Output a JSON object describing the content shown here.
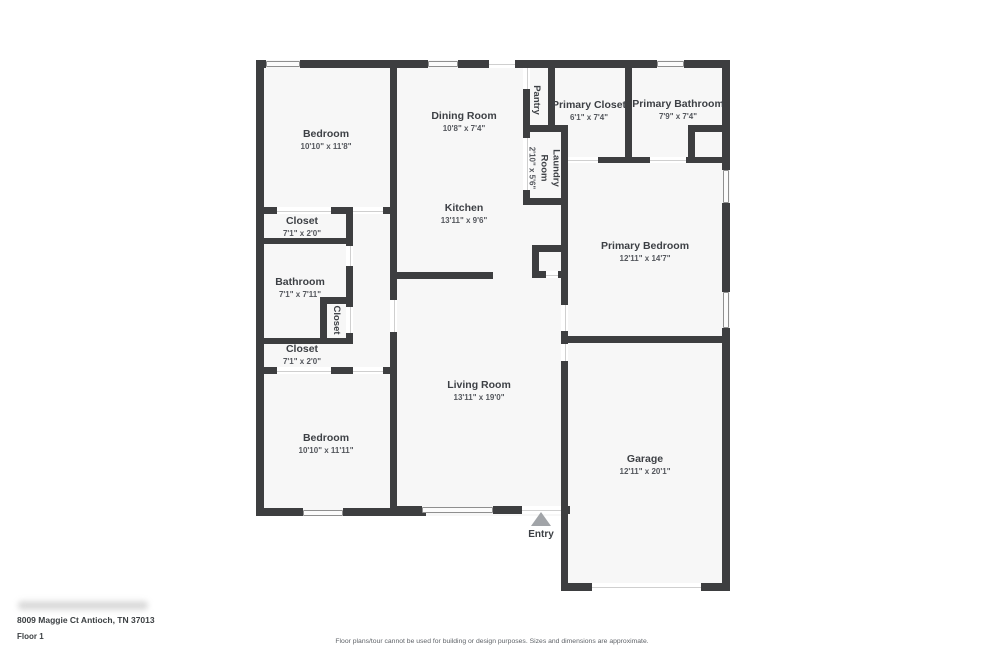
{
  "plan": {
    "wall_color": "#3d3e40",
    "floor_color": "#f7f7f7"
  },
  "rooms": [
    {
      "id": "bedroom-1",
      "name": "Bedroom",
      "dims": "10'10\" x 11'8\""
    },
    {
      "id": "dining-room",
      "name": "Dining Room",
      "dims": "10'8\" x 7'4\""
    },
    {
      "id": "pantry",
      "name": "Pantry",
      "dims": ""
    },
    {
      "id": "primary-closet",
      "name": "Primary Closet",
      "dims": "6'1\" x 7'4\""
    },
    {
      "id": "primary-bathroom",
      "name": "Primary Bathroom",
      "dims": "7'9\" x 7'4\""
    },
    {
      "id": "laundry-room",
      "name": "Laundry Room",
      "dims": "2'10\" x 5'6\""
    },
    {
      "id": "kitchen",
      "name": "Kitchen",
      "dims": "13'11\" x 9'6\""
    },
    {
      "id": "primary-bedroom",
      "name": "Primary Bedroom",
      "dims": "12'11\" x 14'7\""
    },
    {
      "id": "closet-1",
      "name": "Closet",
      "dims": "7'1\" x 2'0\""
    },
    {
      "id": "bathroom",
      "name": "Bathroom",
      "dims": "7'1\" x 7'11\""
    },
    {
      "id": "hall-closet",
      "name": "Closet",
      "dims": ""
    },
    {
      "id": "closet-2",
      "name": "Closet",
      "dims": "7'1\" x 2'0\""
    },
    {
      "id": "living-room",
      "name": "Living Room",
      "dims": "13'11\" x 19'0\""
    },
    {
      "id": "bedroom-2",
      "name": "Bedroom",
      "dims": "10'10\" x 11'11\""
    },
    {
      "id": "garage",
      "name": "Garage",
      "dims": "12'11\" x 20'1\""
    }
  ],
  "entry": {
    "label": "Entry"
  },
  "footer": {
    "address": "8009 Maggie Ct Antioch, TN 37013",
    "floor": "Floor 1",
    "disclaimer": "Floor plans/tour cannot be used for building or design purposes. Sizes and dimensions are approximate."
  }
}
